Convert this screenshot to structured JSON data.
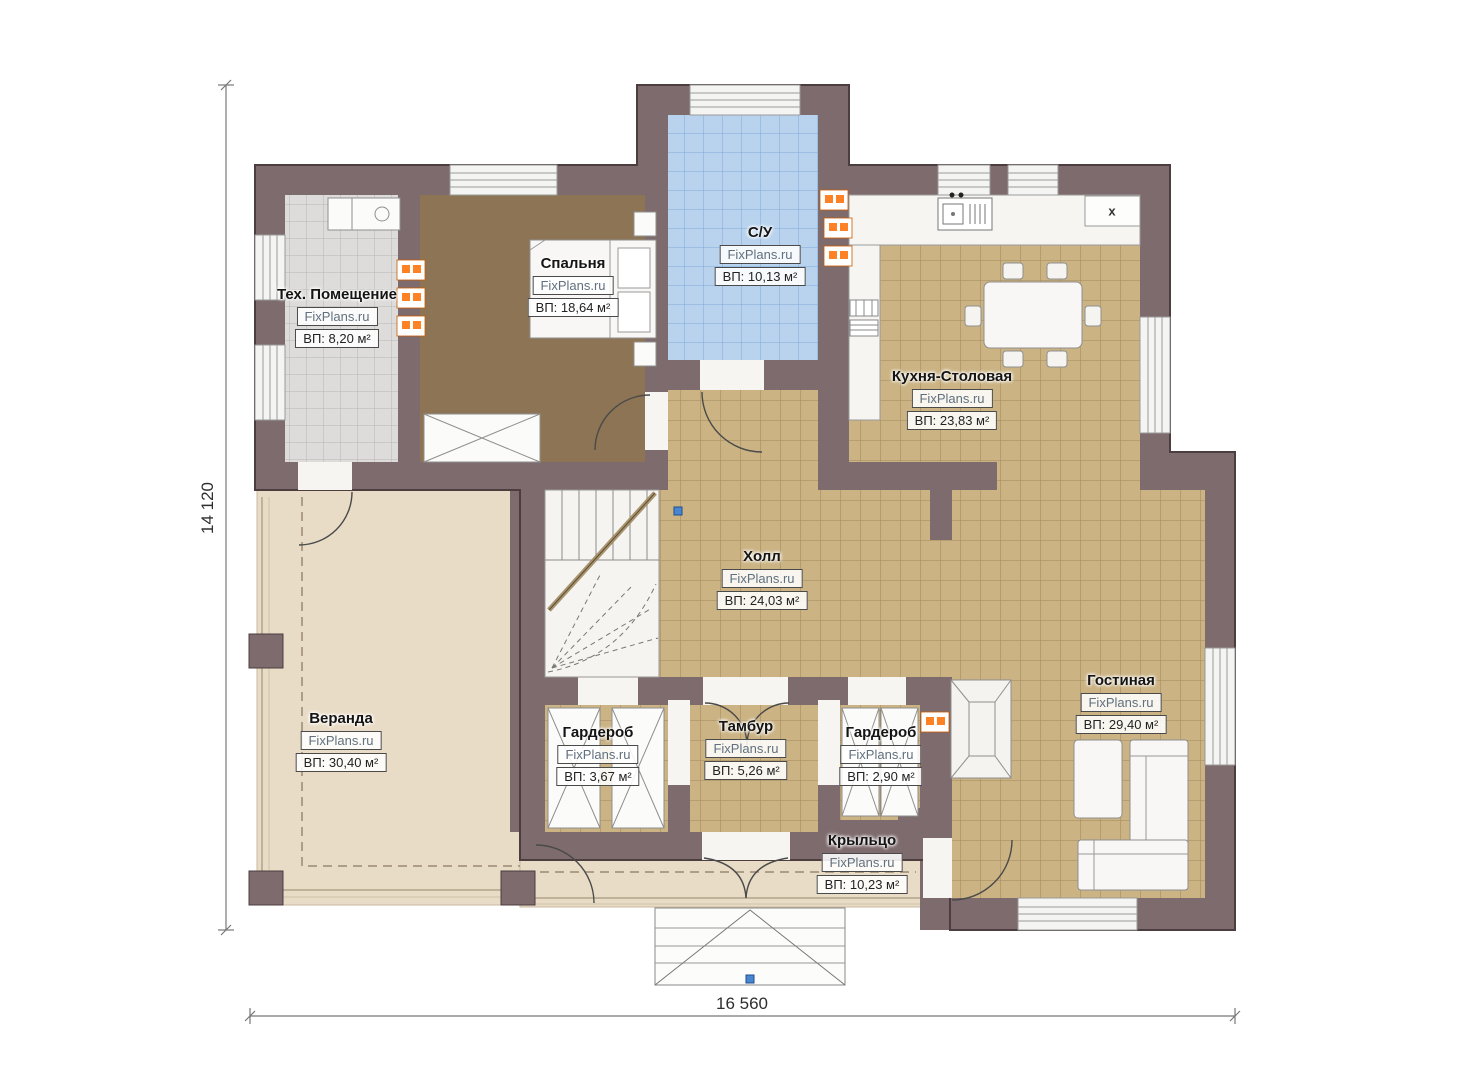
{
  "watermark": "FixPlans.ru",
  "dimensions": {
    "height_label": "14 120",
    "width_label": "16 560"
  },
  "symbols": {
    "stove_label": "x"
  },
  "rooms": [
    {
      "id": "tech",
      "name": "Тех. Помещение",
      "watermark": "FixPlans.ru",
      "area": "ВП: 8,20 м²"
    },
    {
      "id": "bedroom",
      "name": "Спальня",
      "watermark": "FixPlans.ru",
      "area": "ВП: 18,64 м²"
    },
    {
      "id": "bathroom",
      "name": "С/У",
      "watermark": "FixPlans.ru",
      "area": "ВП: 10,13 м²"
    },
    {
      "id": "kitchen",
      "name": "Кухня-Столовая",
      "watermark": "FixPlans.ru",
      "area": "ВП: 23,83 м²"
    },
    {
      "id": "hall",
      "name": "Холл",
      "watermark": "FixPlans.ru",
      "area": "ВП: 24,03 м²"
    },
    {
      "id": "veranda",
      "name": "Веранда",
      "watermark": "FixPlans.ru",
      "area": "ВП: 30,40 м²"
    },
    {
      "id": "wardrobe-left",
      "name": "Гардероб",
      "watermark": "FixPlans.ru",
      "area": "ВП: 3,67 м²"
    },
    {
      "id": "tambour",
      "name": "Тамбур",
      "watermark": "FixPlans.ru",
      "area": "ВП: 5,26 м²"
    },
    {
      "id": "wardrobe-right",
      "name": "Гардероб",
      "watermark": "FixPlans.ru",
      "area": "ВП: 2,90 м²"
    },
    {
      "id": "living",
      "name": "Гостиная",
      "watermark": "FixPlans.ru",
      "area": "ВП: 29,40 м²"
    },
    {
      "id": "porch",
      "name": "Крыльцо",
      "watermark": "FixPlans.ru",
      "area": "ВП: 10,23 м²"
    }
  ],
  "colors": {
    "wall": "#7e6b6d",
    "tile_tan": "#cbb384",
    "tile_gray": "#dddcda",
    "tile_blue": "#b9d3ee",
    "bedroom_floor": "#8c7454",
    "deck": "#e9dcc6",
    "radiator_orange": "#ff8125",
    "marker_blue": "#4a86cf"
  }
}
